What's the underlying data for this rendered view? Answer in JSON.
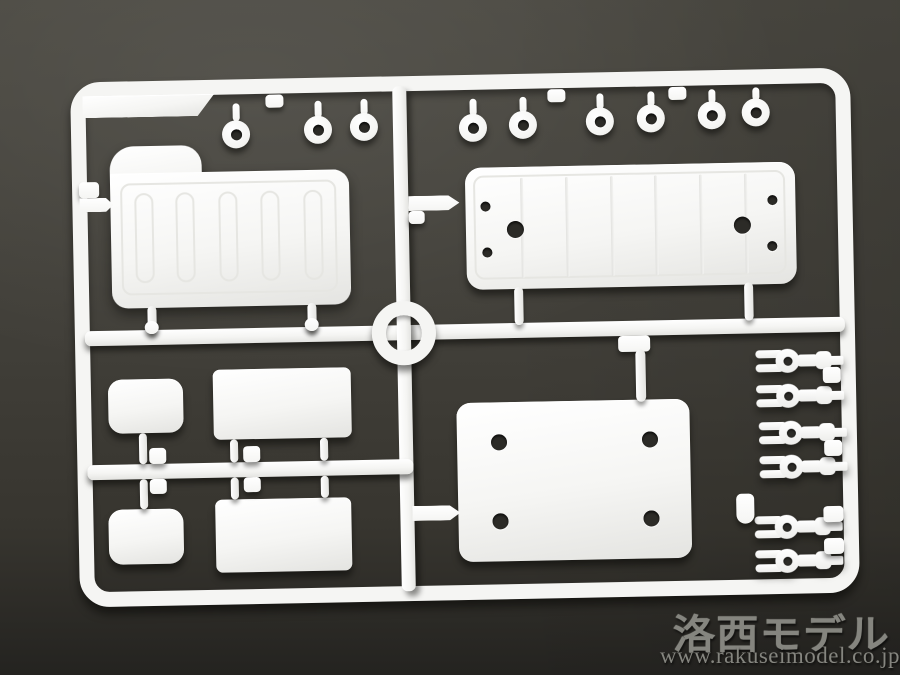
{
  "scene": {
    "description": "Photograph of an unpainted white plastic model-kit parts sprue (runner frame) lying on a dark gray surface",
    "palette": {
      "bg": "#403e38",
      "bg_top": "#4b4942",
      "bg_deep": "#242320",
      "plastic": "#f5f5f3",
      "plastic_shade": "#e4e4e1",
      "hole": "#2c2b27",
      "watermark": "#85857f"
    }
  },
  "watermark": {
    "brand": "洛西モデル",
    "url": "www.rakuseimodel.co.jp"
  },
  "sprue": {
    "inventory": [
      {
        "part": "ribbed panel with stepped hump corner",
        "count": 1
      },
      {
        "part": "long ribbed panel with six holes",
        "count": 1
      },
      {
        "part": "flat rectangular plate with four holes",
        "count": 1
      },
      {
        "part": "round grommet ring",
        "count": 9
      },
      {
        "part": "small rounded plate",
        "count": 2
      },
      {
        "part": "rectangular plate",
        "count": 2
      },
      {
        "part": "fork clevis fitting",
        "count": 6
      },
      {
        "part": "center runner ring",
        "count": 1
      }
    ]
  }
}
